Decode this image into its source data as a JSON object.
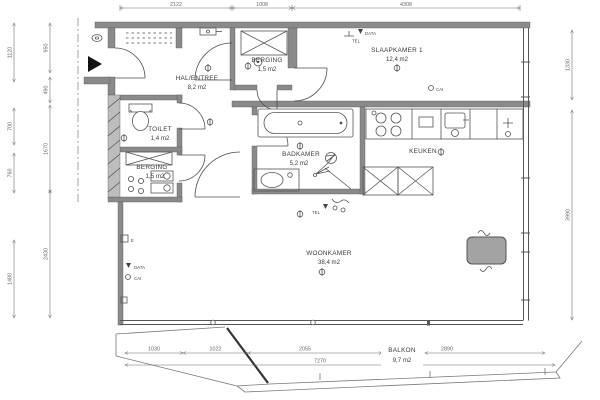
{
  "rooms": {
    "hal": {
      "name": "HAL/ENTREE",
      "area": "8,2 m2"
    },
    "berging_top": {
      "name": "BERGING",
      "area": "1,5 m2"
    },
    "slaapkamer": {
      "name": "SLAAPKAMER 1",
      "area": "12,4 m2"
    },
    "toilet": {
      "name": "TOILET",
      "area": "1,4 m2"
    },
    "berging": {
      "name": "BERGING",
      "area": "1,5 m2"
    },
    "badkamer": {
      "name": "BADKAMER",
      "area": "5,2 m2"
    },
    "keuken": {
      "name": "KEUKEN"
    },
    "woonkamer": {
      "name": "WOONKAMER",
      "area": "38,4 m2"
    },
    "balkon": {
      "name": "BALKON",
      "area": "9,7 m2"
    }
  },
  "dimensions": {
    "top": {
      "d1": "2122",
      "d2": "1008",
      "d3": "4308"
    },
    "bottom": {
      "d1": "1030",
      "d2": "1022",
      "d3": "2055",
      "d4": "2890",
      "total": "7270"
    },
    "left_outer": {
      "d1": "1120",
      "d2": "700",
      "d3": "760",
      "d4": "1480"
    },
    "left_inner": {
      "d1": "950",
      "d2": "490",
      "d3": "1670",
      "d4": "2430"
    },
    "right": {
      "d1": "1330",
      "d2": "3990"
    }
  },
  "labels": {
    "tel": "TEL",
    "data": "DATA",
    "cai": "CAI",
    "e": "E"
  },
  "colors": {
    "wall_fill": "#8a8a8a",
    "wall_hatch_fill": "#bdbdbd",
    "furniture_fill": "#a3a3a3",
    "black": "#141414",
    "line": "#4f4f4f",
    "dim_line": "#6e6e6e"
  }
}
